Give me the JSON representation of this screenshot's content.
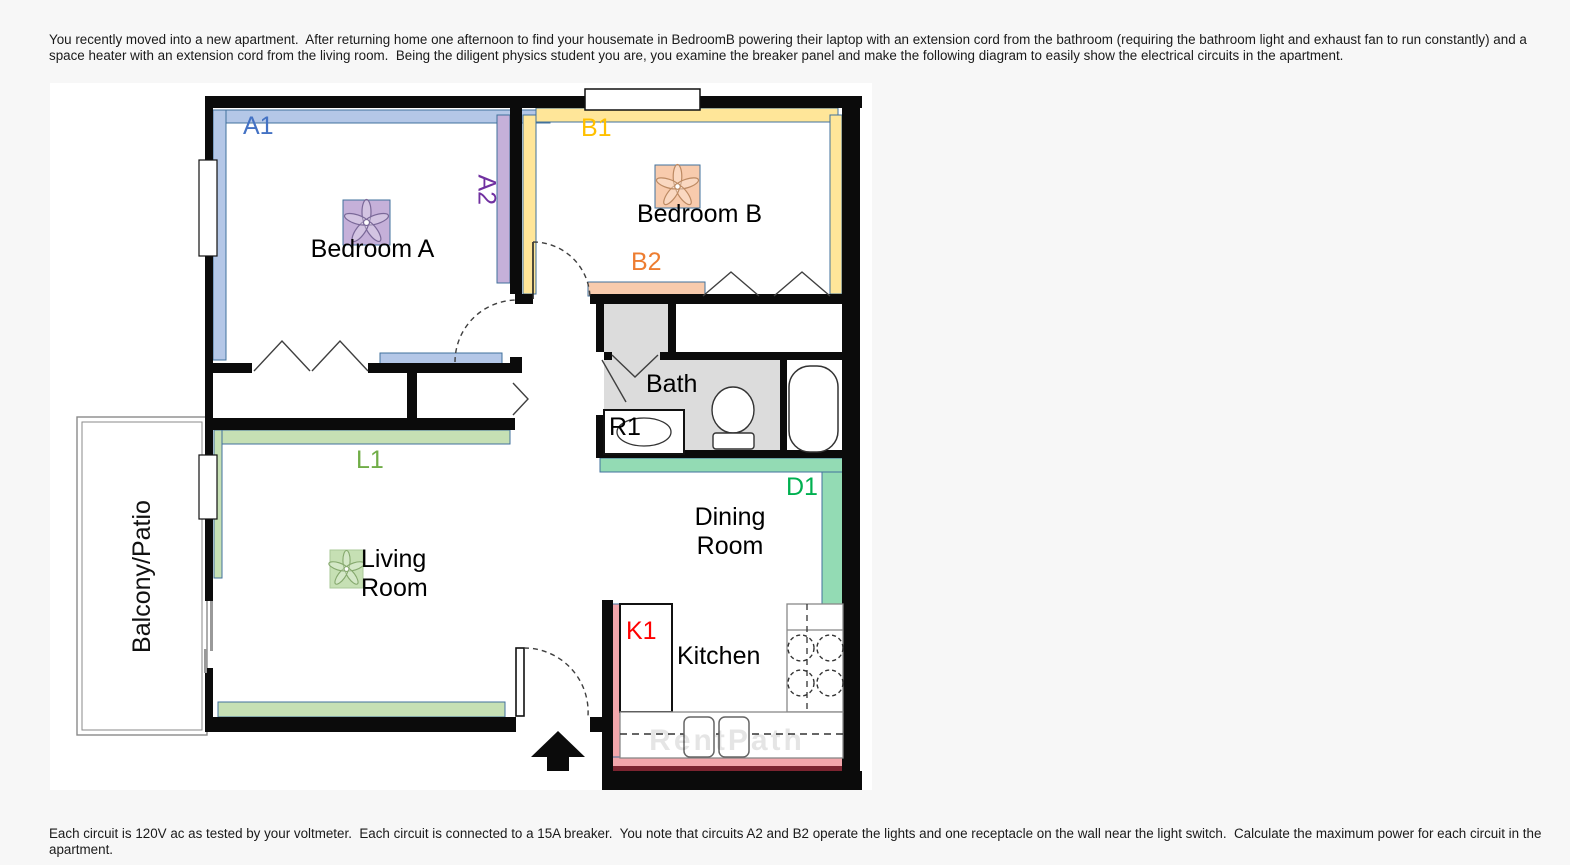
{
  "problem": {
    "intro": "You recently moved into a new apartment.  After returning home one afternoon to find your housemate in BedroomB powering their laptop with an extension cord from the bathroom (requiring the bathroom light and exhaust fan to run constantly) and a space heater with an extension cord from the living room.  Being the diligent physics student you are, you examine the breaker panel and make the following diagram to easily show the electrical circuits in the apartment.",
    "question": "Each circuit is 120V ac as tested by your voltmeter.  Each circuit is connected to a 15A breaker.  You note that circuits A2 and B2 operate the lights and one receptacle on the wall near the light switch.  Calculate the maximum power for each circuit in the apartment."
  },
  "floorplan": {
    "circuits": {
      "a1": {
        "label": "A1",
        "color": "#4472c4",
        "strip_color": "#b4c7e7"
      },
      "a2": {
        "label": "A2",
        "color": "#7030a0",
        "strip_color": "#c5b0d9"
      },
      "b1": {
        "label": "B1",
        "color": "#ffc000",
        "strip_color": "#ffe699"
      },
      "b2": {
        "label": "B2",
        "color": "#ed7d31",
        "strip_color": "#f8cbad"
      },
      "l1": {
        "label": "L1",
        "color": "#70ad47",
        "strip_color": "#c6e0b4"
      },
      "d1": {
        "label": "D1",
        "color": "#00b050",
        "strip_color": "#93dbb4"
      },
      "k1": {
        "label": "K1",
        "color": "#ff0000",
        "strip_color": "#f3a6ab",
        "baseboard_color": "#7c2430"
      },
      "r1": {
        "label": "R1",
        "color": "#000000"
      }
    },
    "rooms": {
      "bedroom_a": "Bedroom A",
      "bedroom_b": "Bedroom B",
      "bath": "Bath",
      "living_line1": "Living",
      "living_line2": "Room",
      "dining_line1": "Dining",
      "dining_line2": "Room",
      "kitchen": "Kitchen",
      "balcony": "Balcony/Patio"
    },
    "watermark": "RentPath"
  }
}
